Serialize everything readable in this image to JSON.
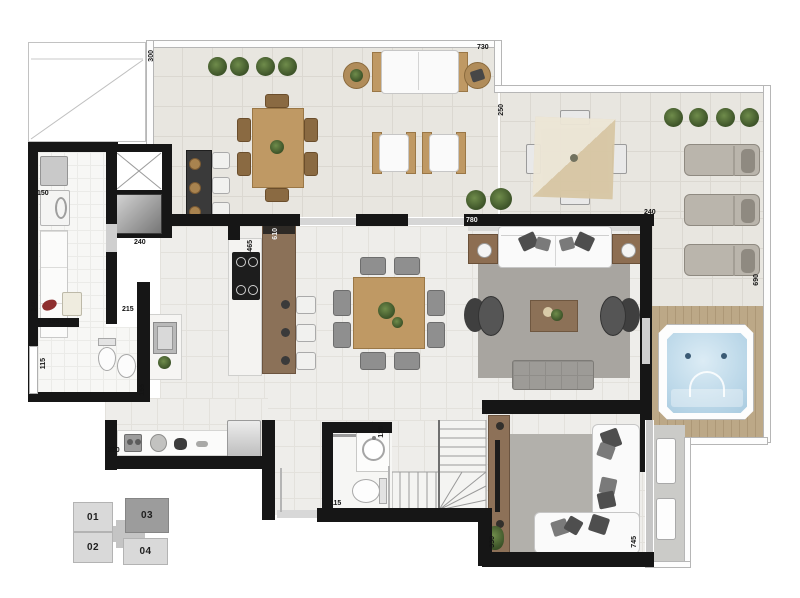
{
  "plan": {
    "type": "apartment-floor-plan",
    "highlighted_unit": "03"
  },
  "dims": {
    "t300": "300",
    "t730": "730",
    "t250": "250",
    "t240": "240",
    "t690": "690",
    "l780": "780",
    "k465": "465",
    "k610": "610",
    "e240": "240",
    "s150": "150",
    "s340": "340",
    "s195": "195",
    "s115": "115",
    "k215": "215",
    "k155": "155",
    "c320": "320",
    "b120": "120",
    "b115": "115",
    "tv330": "330",
    "tv745": "745"
  },
  "keyplan": {
    "units": [
      {
        "label": "01",
        "highlighted": false
      },
      {
        "label": "02",
        "highlighted": false
      },
      {
        "label": "03",
        "highlighted": true
      },
      {
        "label": "04",
        "highlighted": false
      }
    ]
  },
  "colors": {
    "wall": "#161616",
    "wood": "#bf9964",
    "island_wood": "#8b7158",
    "jacuzzi_water": "#bfdaea",
    "terrace_floor": "#e8e6e0",
    "interior_floor": "#eeedea",
    "rug": "#a8a5a0",
    "keyplan_unit": "#d9d9d9",
    "keyplan_highlight": "#9c9c9c"
  }
}
